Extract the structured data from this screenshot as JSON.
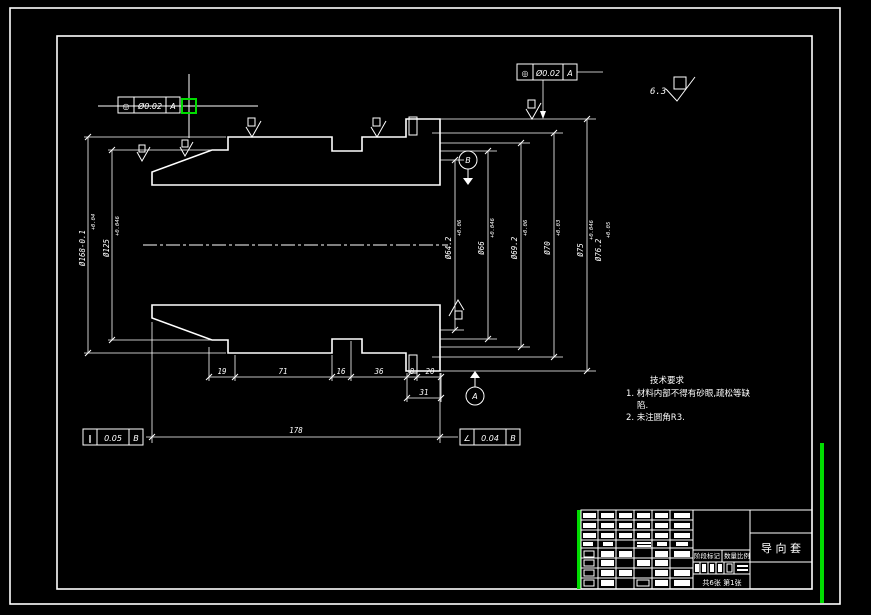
{
  "app": {
    "background": "#000000",
    "line_color": "#ffffff",
    "highlight_color": "#00dc00"
  },
  "technical_notes": {
    "title": "技术要求",
    "line1": "1. 材料内部不得有砂眼,疏松等缺",
    "line2": "陷.",
    "line3": "2. 未注圆角R3."
  },
  "title_block": {
    "part_name": "导  向  套",
    "stage_label": "阶段标记",
    "qty_scale_label": "数量比例",
    "sheet_label": "共6张  第1张"
  },
  "surface_finish": {
    "rest_value": "6.3"
  },
  "tolerance_frames": {
    "top_left": {
      "symbol": "◎",
      "value": "Ø0.02",
      "datum": "A"
    },
    "top_right": {
      "symbol": "◎",
      "value": "Ø0.02",
      "datum": "A"
    },
    "bottom_left": {
      "symbol": "∥",
      "value": "0.05",
      "datum": "B"
    },
    "bottom_right": {
      "symbol": "∠",
      "value": "0.04",
      "datum": "B"
    }
  },
  "datum_labels": {
    "top": "B",
    "bottom": "A"
  },
  "dimensions": {
    "left": [
      {
        "main": "Ø168-0.1",
        "tol": "+0.04"
      },
      {
        "main": "Ø125",
        "tol": "+0.046"
      }
    ],
    "right": [
      {
        "main": "Ø64.2",
        "tol": "+0.06"
      },
      {
        "main": "Ø66",
        "tol": "+0.046"
      },
      {
        "main": "Ø69.2",
        "tol": "+0.06"
      },
      {
        "main": "Ø70",
        "tol": "+0.03"
      },
      {
        "main": "Ø75",
        "tol": "+0.046"
      },
      {
        "main": "Ø76.2",
        "tol": "+0.05"
      }
    ],
    "bottom_chain": [
      "19",
      "71",
      "16",
      "36",
      "8",
      "20"
    ],
    "step": "31",
    "overall": "178"
  }
}
